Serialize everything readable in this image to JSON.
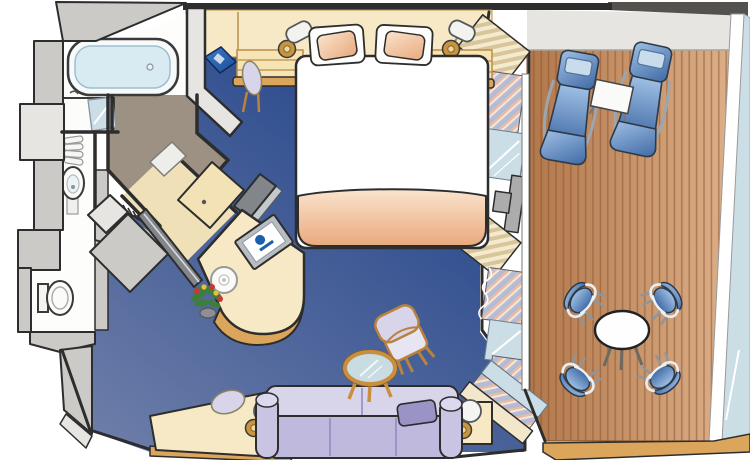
{
  "meta": {
    "subject": "Cruise ship suite stateroom floor plan with private balcony",
    "canvas": {
      "width": 750,
      "height": 460
    }
  },
  "palette": {
    "outline": "#2d2d2d",
    "wallGray": "#cbcac6",
    "wallLight": "#e6e5e1",
    "taupe": "#9c9182",
    "cream": "#f7e9c5",
    "creamDeep": "#f0dcab",
    "tan": "#dba65c",
    "tanDark": "#b9823e",
    "carpetLight": "#6f7fa9",
    "carpetDark": "#1f4188",
    "woodLight": "#ddb089",
    "woodDark": "#b1774a",
    "plankLine": "#8a5330",
    "deckEdge": "#dcc096",
    "balconyWall": "#eae9e4",
    "glassRail": "#d3e8f1",
    "glass": "#cbdee6",
    "white": "#fdfdfb",
    "tubInner": "#d8eaf2",
    "salmonLight": "#fae4ce",
    "salmonDark": "#e9a97c",
    "lavLight": "#d8d4ea",
    "lavMid": "#bfb9de",
    "lavDark": "#9a93c6",
    "gold": "#c89440",
    "chrome": "#9aa6b0",
    "blueLight": "#9fc0e4",
    "blueDark": "#3f69a5",
    "screenBlue": "#1c5fac",
    "doorGray": "#acacac",
    "mirror": "#82858a",
    "green": "#3f7d3c",
    "red": "#c63a34",
    "yellow": "#e5c235"
  },
  "scene": {
    "rooms": [
      {
        "id": "bathroom",
        "items": [
          "bathtub",
          "vanity-counter",
          "vanity-mirror",
          "towel-stack",
          "pedestal-sink",
          "toilet"
        ]
      },
      {
        "id": "entry",
        "items": [
          "entry-door"
        ]
      },
      {
        "id": "closet",
        "items": [
          "hanger-rod",
          "closet-mirror-panel",
          "closet-door-panel",
          "wardrobe-door",
          "safe"
        ]
      },
      {
        "id": "bedroom",
        "items": [
          "queen-bed",
          "pillow",
          "pillow",
          "nightstand",
          "nightstand",
          "bedside-lamp",
          "bedside-lamp",
          "dressing-chair",
          "guest-book",
          "tv",
          "mirror-slab",
          "vanity-desk",
          "plate",
          "flower-vase"
        ]
      },
      {
        "id": "sitting-area",
        "items": [
          "sofa",
          "lumbar-pillow",
          "armchair",
          "coffee-table",
          "writing-desk",
          "desk-chair",
          "desk-lamp",
          "end-table",
          "end-table-lamp"
        ]
      },
      {
        "id": "window-wall",
        "items": [
          "drape",
          "curtain",
          "glass-panel",
          "sliding-door-handle",
          "drape",
          "curtain",
          "glass-panel",
          "curtain",
          "door-track"
        ]
      },
      {
        "id": "balcony",
        "items": [
          "teak-deck",
          "lounge-chair",
          "lounge-chair",
          "side-table",
          "round-table",
          "deck-chair",
          "deck-chair",
          "deck-chair",
          "deck-chair",
          "glass-railing"
        ]
      }
    ]
  }
}
